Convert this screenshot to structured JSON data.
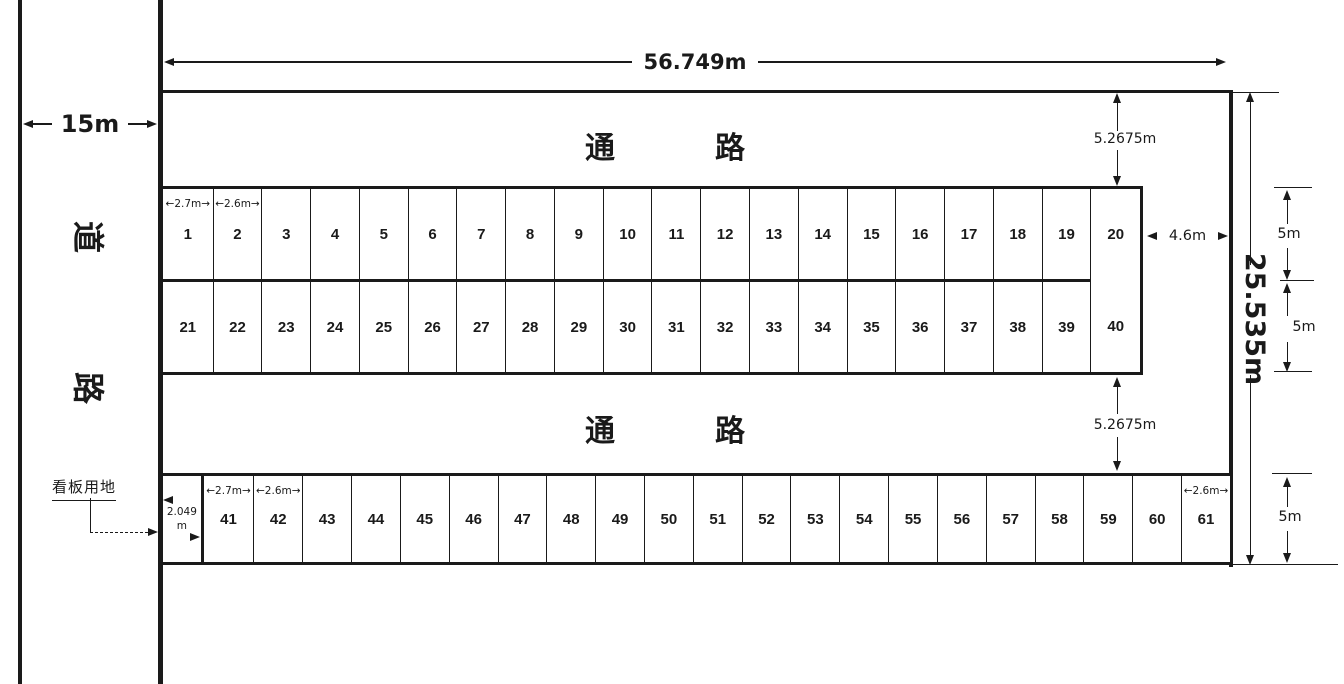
{
  "road": {
    "name_char1": "道",
    "name_char2": "路",
    "width_label": "15m"
  },
  "signboard": {
    "label": "看板用地",
    "width_line1": "2.049",
    "width_line2": "m"
  },
  "aisle_top": {
    "char1": "通",
    "char2": "路"
  },
  "aisle_bottom": {
    "char1": "通",
    "char2": "路"
  },
  "dimensions": {
    "total_width": "56.749m",
    "total_height": "25.535m",
    "aisle_top_height": "5.2675m",
    "aisle_bottom_height": "5.2675m",
    "right_gap": "4.6m",
    "row1_height": "5m",
    "row2_height": "5m",
    "row3_height": "5m"
  },
  "block_main": {
    "col_widths_m": [
      2.7,
      2.6,
      2.6,
      2.6,
      2.6,
      2.6,
      2.6,
      2.6,
      2.6,
      2.6,
      2.6,
      2.6,
      2.6,
      2.6,
      2.6,
      2.6,
      2.6,
      2.6,
      2.6,
      2.65
    ],
    "top_numbers": [
      "1",
      "2",
      "3",
      "4",
      "5",
      "6",
      "7",
      "8",
      "9",
      "10",
      "11",
      "12",
      "13",
      "14",
      "15",
      "16",
      "17",
      "18",
      "19",
      "20"
    ],
    "bottom_numbers": [
      "21",
      "22",
      "23",
      "24",
      "25",
      "26",
      "27",
      "28",
      "29",
      "30",
      "31",
      "32",
      "33",
      "34",
      "35",
      "36",
      "37",
      "38",
      "39",
      "40"
    ],
    "width_tags": {
      "0": "←2.7m→",
      "1": "←2.6m→"
    }
  },
  "row_bottom": {
    "sign_cell_width_m": 2.049,
    "widths_m": [
      2.7,
      2.6,
      2.6,
      2.6,
      2.6,
      2.6,
      2.6,
      2.6,
      2.6,
      2.6,
      2.6,
      2.6,
      2.6,
      2.6,
      2.6,
      2.6,
      2.6,
      2.6,
      2.6,
      2.6,
      2.6
    ],
    "numbers": [
      "41",
      "42",
      "43",
      "44",
      "45",
      "46",
      "47",
      "48",
      "49",
      "50",
      "51",
      "52",
      "53",
      "54",
      "55",
      "56",
      "57",
      "58",
      "59",
      "60",
      "61"
    ],
    "width_tags": {
      "0": "←2.7m→",
      "1": "←2.6m→",
      "20": "←2.6m→"
    }
  },
  "colors": {
    "ink": "#1a1a1a",
    "background": "#ffffff"
  }
}
